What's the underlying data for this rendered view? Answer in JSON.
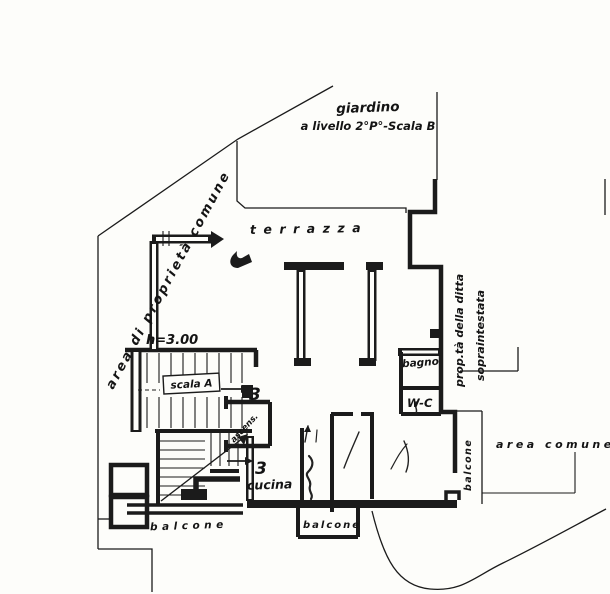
{
  "colors": {
    "ink": "#1b1b1b",
    "paper": "#fdfdfa"
  },
  "site": {
    "giardino_line1": "giardino",
    "giardino_line2": "a livello 2°P°-Scala B",
    "area_proprieta_comune": "area di proprietà comune",
    "area_comune": "area comune",
    "prop_ditta_line1": "prop.tà della ditta",
    "prop_ditta_line2": "sopraintestata"
  },
  "rooms": {
    "terrazza": "terrazza",
    "cucina": "cucina",
    "bagno": "bagno",
    "wc": "W-C",
    "scala": "scala A",
    "ascensore": "ascens.",
    "balcone_sw": "balcone",
    "balcone_s": "balcone",
    "balcone_e": "balcone"
  },
  "annotations": {
    "height": "h=3.00",
    "flight_number_1": "3",
    "flight_number_2": "3"
  }
}
